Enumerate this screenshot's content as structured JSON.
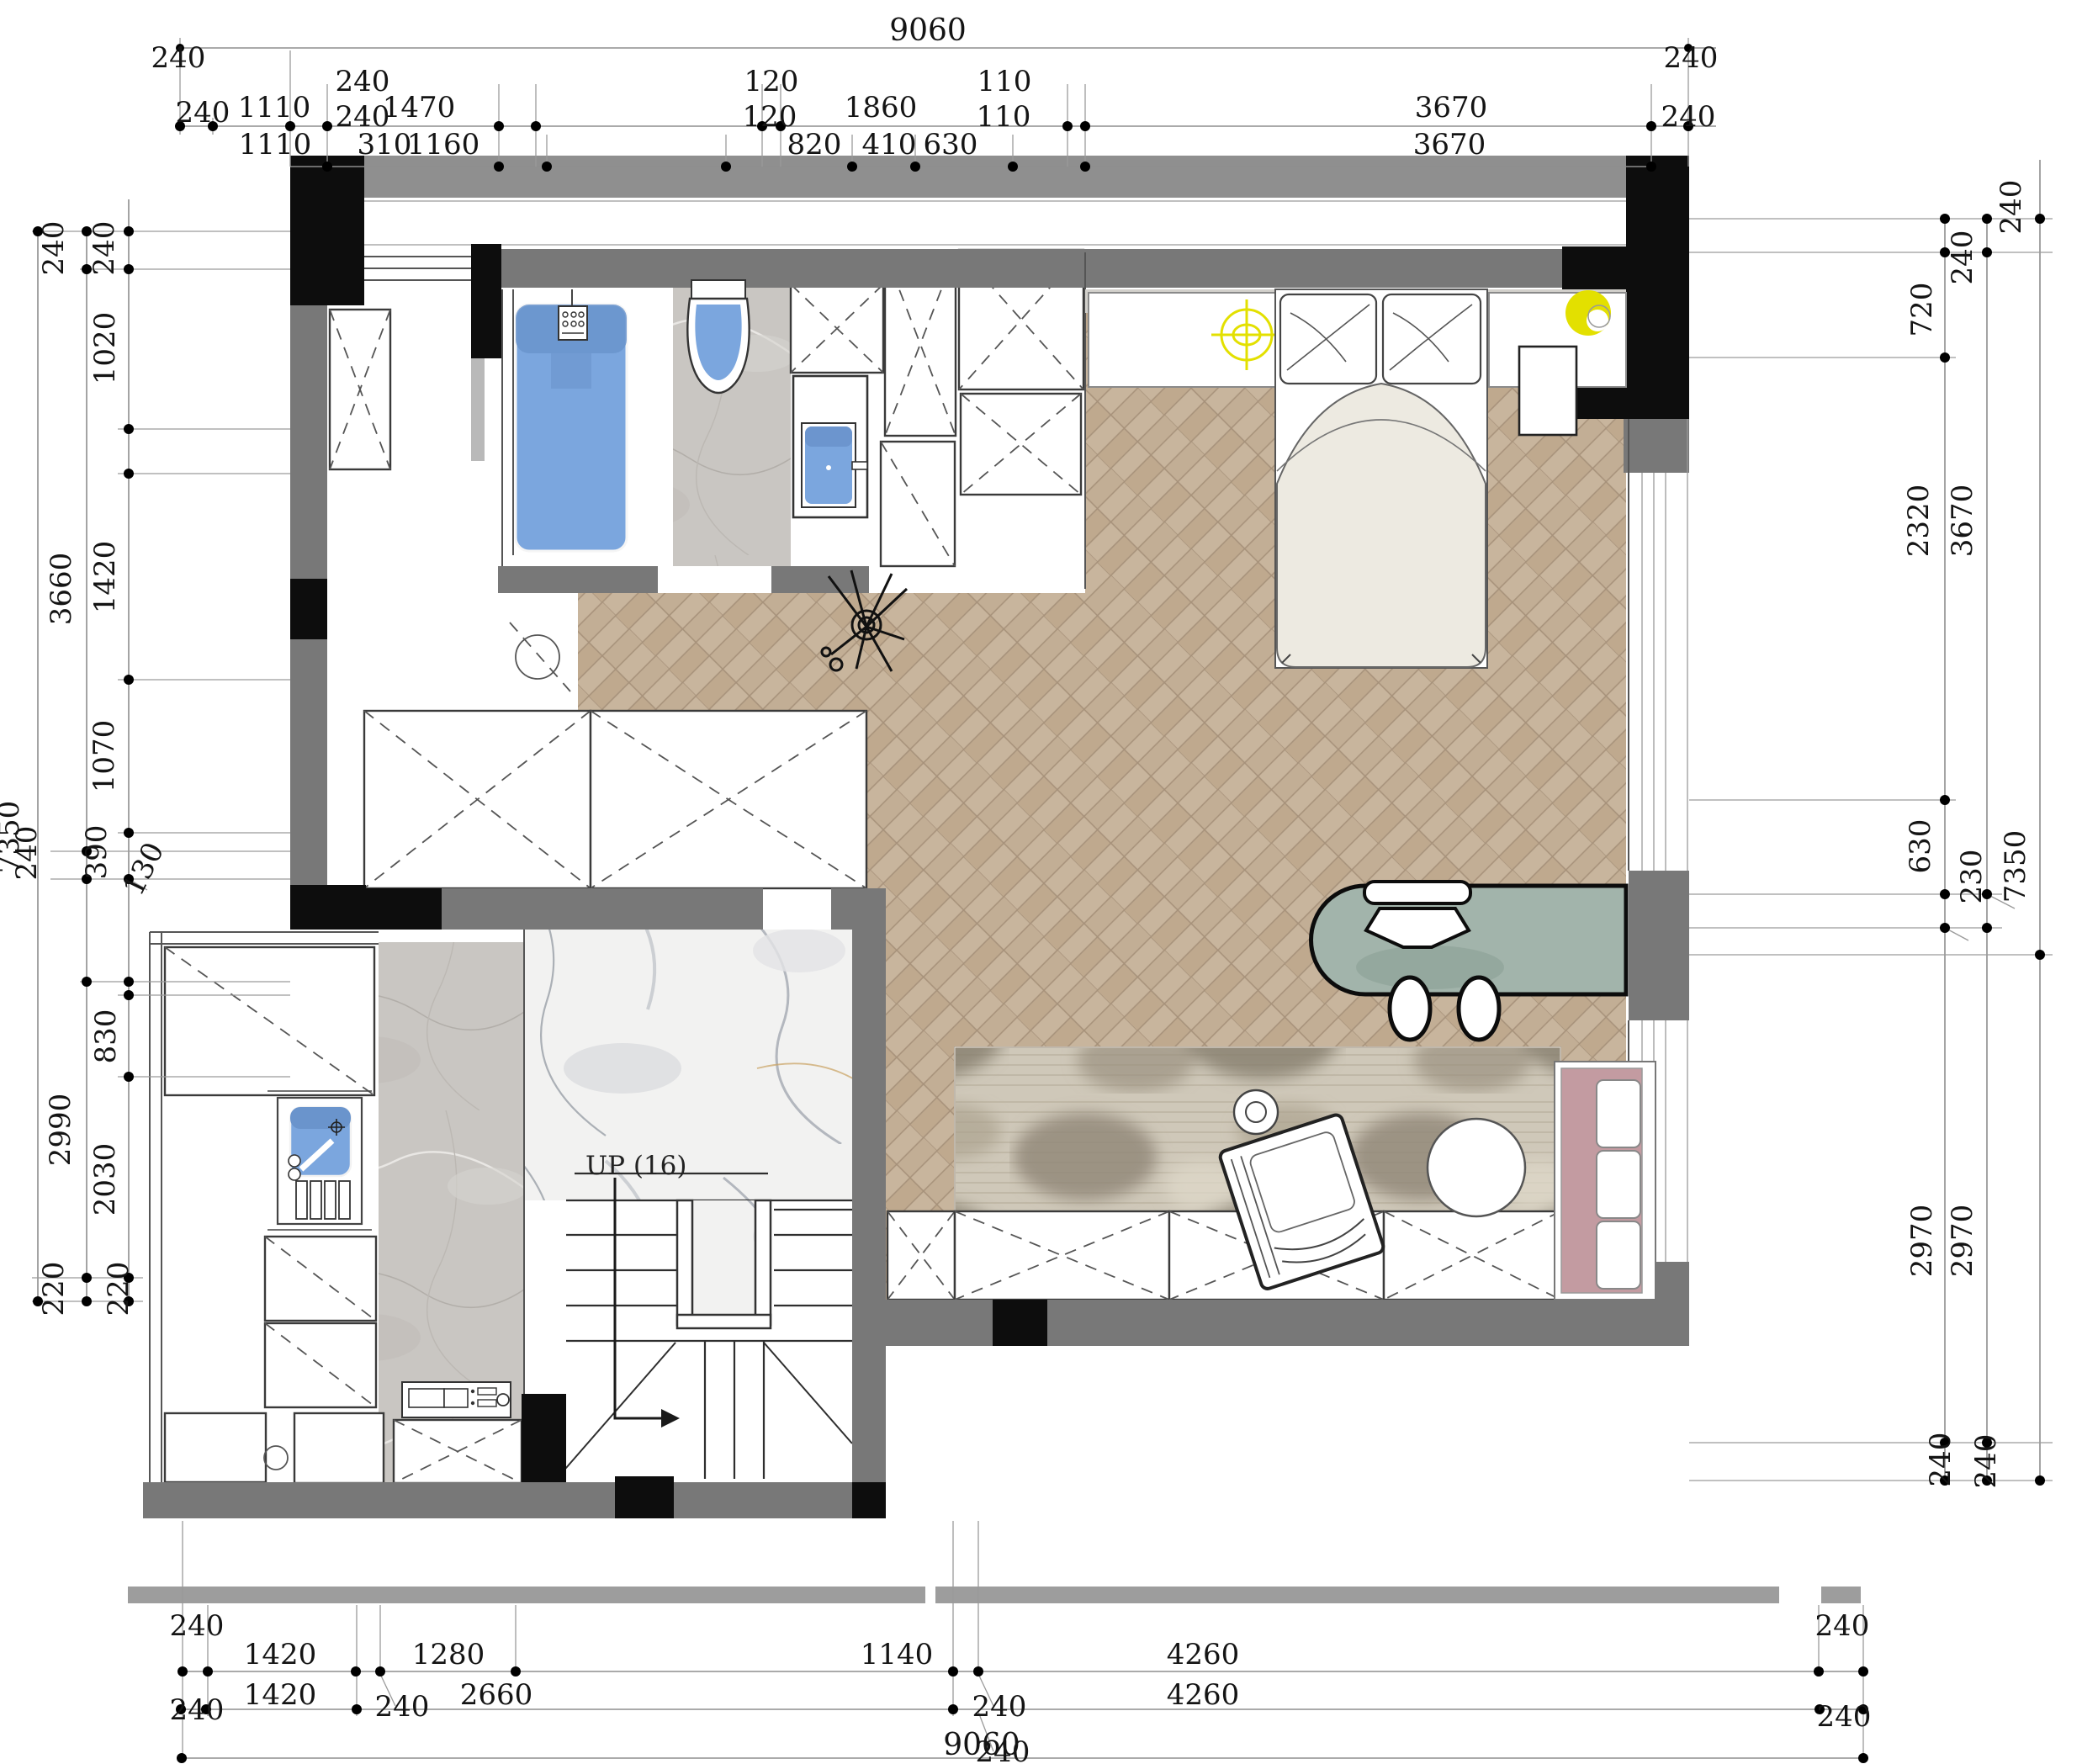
{
  "drawing": {
    "type": "floor-plan",
    "units": "mm"
  },
  "colors": {
    "wall_gray": "#787878",
    "wall_light_gray": "#8f8f8f",
    "wall_black": "#0d0d0d",
    "fixture_blue": "#7ba6de",
    "fixture_blue_dark": "#6a94cc",
    "desk_green": "#a2b4ab",
    "sofa_pink": "#c39ba1",
    "accent_yellow": "#e3e000",
    "duvet_cream": "#edeae1",
    "wood_tone": "#c8b59d",
    "marble_gray": "#c9c6c2",
    "marble_white": "#f2f2f1",
    "rug_base": "#cfc8b9"
  },
  "labels": {
    "stairs_up": "UP (16)"
  },
  "dims": {
    "top": {
      "total": "9060",
      "left_cap": "240",
      "right_cap": "240",
      "raised": [
        "240",
        "120",
        "110"
      ],
      "row_b": [
        "240",
        "1110",
        "240",
        "1470",
        "120",
        "1860",
        "110",
        "3670",
        "240"
      ],
      "row_c": [
        "1110",
        "310",
        "1160",
        "820",
        "410",
        "630",
        "3670"
      ]
    },
    "bottom": {
      "row1": [
        "1420",
        "1280",
        "1140",
        "4260"
      ],
      "row1_caps": [
        "240",
        "240"
      ],
      "row2": [
        "1420",
        "240",
        "2660",
        "240",
        "4260"
      ],
      "row2_caps": [
        "240",
        "240"
      ],
      "total": "9060",
      "total_overlap": "240"
    },
    "left": [
      "240",
      "240",
      "1020",
      "3660",
      "1420",
      "1070",
      "7350",
      "240",
      "390",
      "130",
      "830",
      "2990",
      "2030",
      "220",
      "220"
    ],
    "right": [
      "240",
      "240",
      "720",
      "2320",
      "3670",
      "630",
      "230",
      "7350",
      "2970",
      "2970",
      "240",
      "240"
    ]
  }
}
